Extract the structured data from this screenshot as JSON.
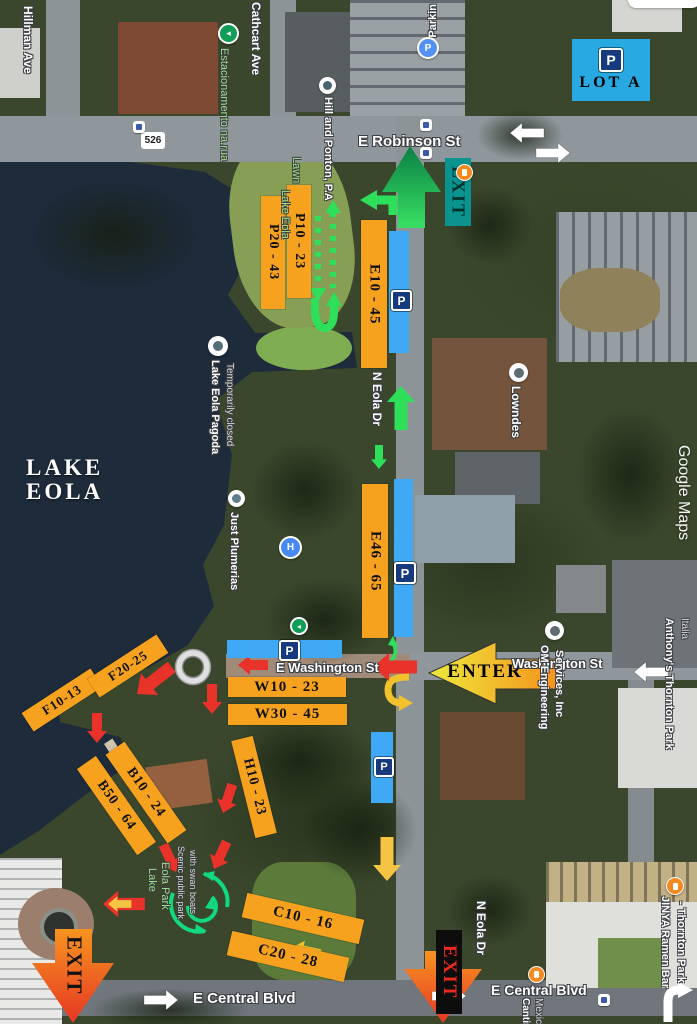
{
  "map": {
    "watermark": "Google Maps",
    "route_shield": "526",
    "streets": {
      "robinson": "E Robinson St",
      "washington_park": "E Washington St",
      "washington_east": "Washington St",
      "central_left": "E Central Blvd",
      "central_right": "E Central Blvd",
      "eola_top": "N Eola Dr",
      "eola_bottom": "N Eola Dr",
      "hillman": "Hillman Ave",
      "cathcart": "Cathcart Ave"
    },
    "lake": {
      "line1": "LAKE",
      "line2": "EOLA"
    },
    "pois": {
      "estacionamento": "Estacionamento na.rua",
      "parking_garage": "Parkin",
      "hill_ponton": "Hill and Ponton, P.A",
      "lawn_label_1": "Lake Eola",
      "lawn_label_2": "Lawn",
      "pagoda": "Lake Eola Pagoda",
      "pagoda_sub": "Temporarily closed",
      "just_plumerias": "Just Plumerias",
      "lowndes": "Lowndes",
      "om_engineering_1": "OM Engineering",
      "om_engineering_2": "Services, Inc",
      "anthonys": "Anthony's Thornton Park",
      "anthonys_sub": "Italia",
      "jinya_1": "JINYA Ramen Bar",
      "jinya_2": "- Thornton Park",
      "cantina_1": "Cantina",
      "cantina_2": "Mexican",
      "park_label_1": "Lake",
      "park_label_2": "Eola Park",
      "park_sub_1": "Scenic public park",
      "park_sub_2": "with swan boats"
    }
  },
  "overlay": {
    "lot_a": "LOT A",
    "enter": "ENTER",
    "exit_top": "EXIT",
    "exit_bottom_left": "EXIT",
    "exit_bottom_mid": "EXIT",
    "p_sign": "P",
    "sections": [
      {
        "id": "P10",
        "label": "P10 - 23"
      },
      {
        "id": "P20",
        "label": "P20 - 43"
      },
      {
        "id": "E10",
        "label": "E10 - 45"
      },
      {
        "id": "E46",
        "label": "E46 - 65"
      },
      {
        "id": "W10",
        "label": "W10 - 23"
      },
      {
        "id": "W30",
        "label": "W30 - 45"
      },
      {
        "id": "H10",
        "label": "H10 - 23"
      },
      {
        "id": "B10",
        "label": "B10 - 24"
      },
      {
        "id": "B50",
        "label": "B50 - 64"
      },
      {
        "id": "F10",
        "label": "F10-13"
      },
      {
        "id": "F20",
        "label": "F20-25"
      },
      {
        "id": "C10",
        "label": "C10 - 16"
      },
      {
        "id": "C20",
        "label": "C20 - 28"
      }
    ],
    "colors": {
      "section_orange": "#F7A21E",
      "parking_blue": "#3FA9F5",
      "lot_a_blue": "#29A9E1",
      "route_green": "#2EE059",
      "alert_red": "#E8322A",
      "caution_yellow": "#F6C445",
      "exit_teal": "#0B9390",
      "exit_gradient_top": "#F79420",
      "exit_gradient_bottom": "#E63723",
      "enter_gradient_left": "#EDE93C",
      "enter_gradient_right": "#F6921E"
    }
  }
}
